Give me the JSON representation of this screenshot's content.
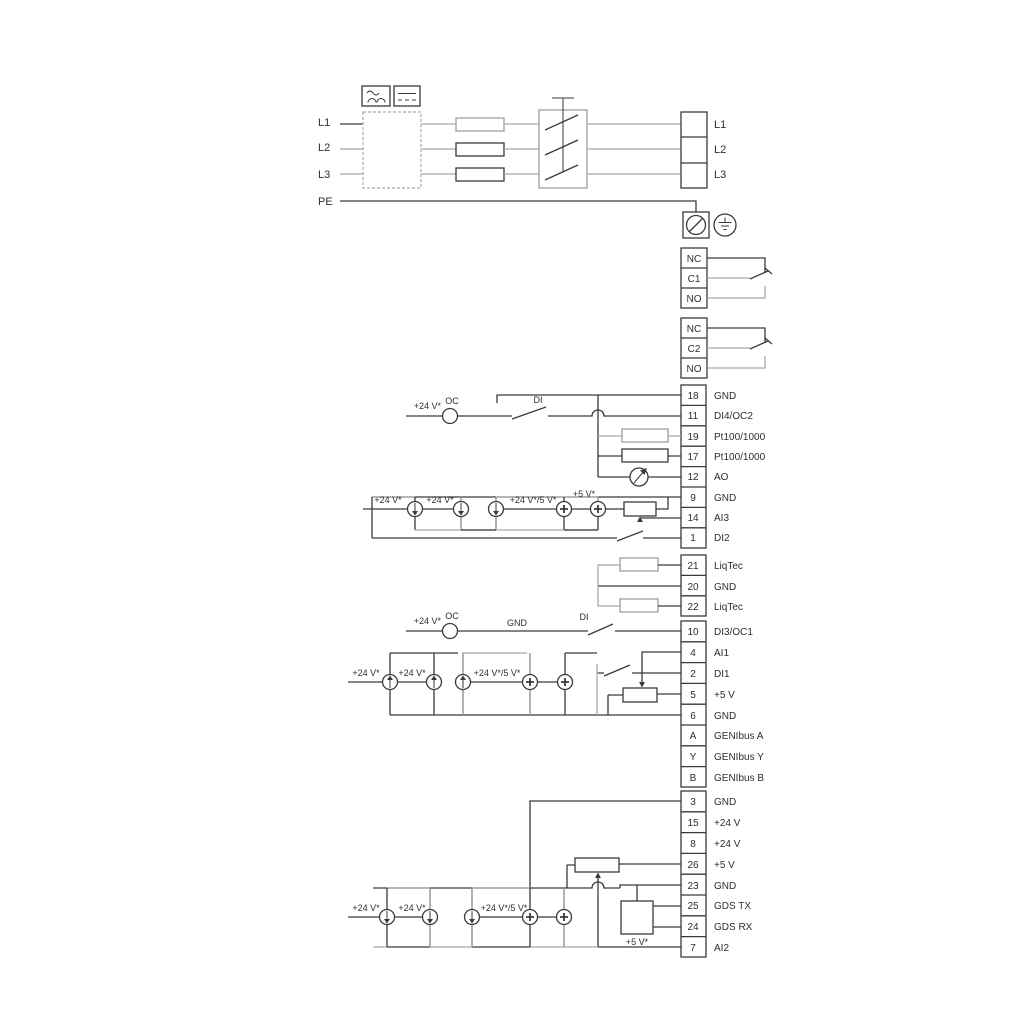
{
  "colors": {
    "line_dark": "#3a3a3a",
    "line_gray": "#a9a9a9",
    "text": "#2e2e2e",
    "background": "#ffffff"
  },
  "power": {
    "left": [
      "L1",
      "L2",
      "L3",
      "PE"
    ],
    "right": [
      "L1",
      "L2",
      "L3"
    ]
  },
  "relay1": [
    "NC",
    "C1",
    "NO"
  ],
  "relay2": [
    "NC",
    "C2",
    "NO"
  ],
  "io1": [
    {
      "n": "18",
      "l": "GND"
    },
    {
      "n": "11",
      "l": "DI4/OC2"
    },
    {
      "n": "19",
      "l": "Pt100/1000"
    },
    {
      "n": "17",
      "l": "Pt100/1000"
    },
    {
      "n": "12",
      "l": "AO"
    },
    {
      "n": "9",
      "l": "GND"
    },
    {
      "n": "14",
      "l": "AI3"
    },
    {
      "n": "1",
      "l": "DI2"
    }
  ],
  "io2": [
    {
      "n": "21",
      "l": "LiqTec"
    },
    {
      "n": "20",
      "l": "GND"
    },
    {
      "n": "22",
      "l": "LiqTec"
    }
  ],
  "io3": [
    {
      "n": "10",
      "l": "DI3/OC1"
    },
    {
      "n": "4",
      "l": "AI1"
    },
    {
      "n": "2",
      "l": "DI1"
    },
    {
      "n": "5",
      "l": "+5 V"
    },
    {
      "n": "6",
      "l": "GND"
    },
    {
      "n": "A",
      "l": "GENIbus A"
    },
    {
      "n": "Y",
      "l": "GENIbus Y"
    },
    {
      "n": "B",
      "l": "GENIbus B"
    }
  ],
  "io4": [
    {
      "n": "3",
      "l": "GND"
    },
    {
      "n": "15",
      "l": "+24 V"
    },
    {
      "n": "8",
      "l": "+24 V"
    },
    {
      "n": "26",
      "l": "+5 V"
    },
    {
      "n": "23",
      "l": "GND"
    },
    {
      "n": "25",
      "l": "GDS TX"
    },
    {
      "n": "24",
      "l": "GDS RX"
    },
    {
      "n": "7",
      "l": "AI2"
    }
  ],
  "ann": {
    "oc1": {
      "v24": "+24 V*",
      "oc": "OC",
      "di": "DI"
    },
    "oc2": {
      "v24": "+24 V*",
      "oc": "OC",
      "gnd": "GND",
      "di": "DI"
    },
    "row1": [
      "+24 V*",
      "+24 V*",
      "+24 V*/5 V*",
      "+5 V*"
    ],
    "row2": [
      "+24 V*",
      "+24 V*",
      "+24 V*/5 V*"
    ],
    "row3": [
      "+24 V*",
      "+24 V*",
      "+24 V*/5 V*",
      "+5 V*"
    ]
  }
}
